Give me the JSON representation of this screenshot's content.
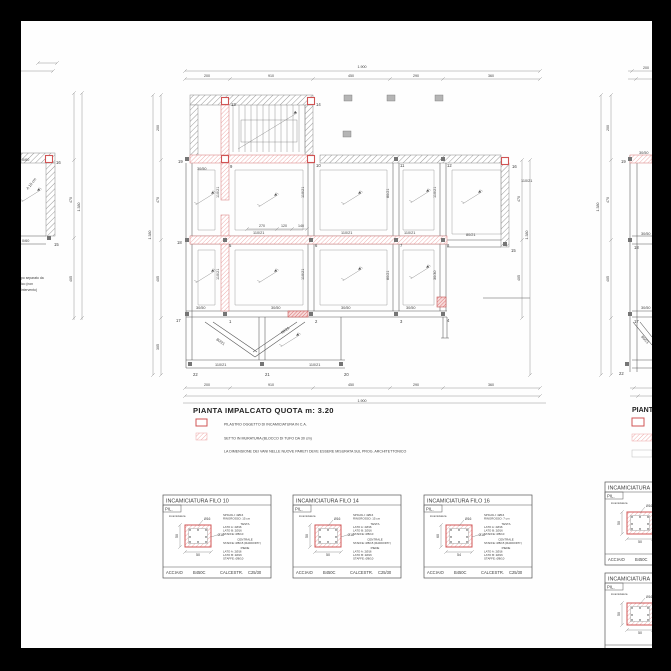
{
  "page": {
    "bg": "#000000",
    "sheet_bg": "#ffffff",
    "line_color": "#555555",
    "red_accent": "#d05454",
    "red_hatch": "#eda7a7",
    "gray_hatch": "#9a9a9a"
  },
  "title_block": {
    "title": "PIANTA IMPALCATO QUOTA m: 3.20",
    "legend": [
      {
        "swatch": "red-outline",
        "label": "PILASTRO OGGETTO DI INCAMICIATURA IN C.A."
      },
      {
        "swatch": "red-hatch",
        "label": "SETTO IN MURATURA (BLOCCO DI TUFO DA 30 cm)"
      },
      {
        "swatch": "none",
        "label": "LA DIMENSIONE DEI VANI NELLE NUOVE PARETI DEVE ESSERE MISURATA SUL PROG. ARCHITETTONICO"
      }
    ]
  },
  "main_plan": {
    "nodes": [
      {
        "id": "19",
        "x": 187,
        "y": 159,
        "lx": 178,
        "ly": 163
      },
      {
        "id": "13",
        "x": 225,
        "y": 101,
        "red": true,
        "lx": 231,
        "ly": 106
      },
      {
        "id": "14",
        "x": 311,
        "y": 101,
        "red": true,
        "lx": 316,
        "ly": 106
      },
      {
        "id": "9",
        "x": 225,
        "y": 159,
        "red": true,
        "lx": 230,
        "ly": 168
      },
      {
        "id": "10",
        "x": 311,
        "y": 159,
        "red": true,
        "lx": 316,
        "ly": 167
      },
      {
        "id": "11",
        "x": 396,
        "y": 159,
        "lx": 400,
        "ly": 167
      },
      {
        "id": "12",
        "x": 443,
        "y": 159,
        "lx": 447,
        "ly": 167
      },
      {
        "id": "16",
        "x": 505,
        "y": 161,
        "red": true,
        "lx": 512,
        "ly": 168
      },
      {
        "id": "18",
        "x": 187,
        "y": 240,
        "lx": 177,
        "ly": 244
      },
      {
        "id": "5",
        "x": 225,
        "y": 240,
        "lx": 229,
        "ly": 247
      },
      {
        "id": "6",
        "x": 311,
        "y": 240,
        "lx": 315,
        "ly": 247
      },
      {
        "id": "7",
        "x": 396,
        "y": 240,
        "lx": 400,
        "ly": 247
      },
      {
        "id": "8",
        "x": 443,
        "y": 240,
        "lx": 447,
        "ly": 247
      },
      {
        "id": "15",
        "x": 505,
        "y": 244,
        "lx": 511,
        "ly": 252
      },
      {
        "id": "17",
        "x": 187,
        "y": 314,
        "lx": 176,
        "ly": 322
      },
      {
        "id": "1",
        "x": 225,
        "y": 314,
        "lx": 229,
        "ly": 323
      },
      {
        "id": "2",
        "x": 311,
        "y": 314,
        "lx": 315,
        "ly": 323
      },
      {
        "id": "3",
        "x": 396,
        "y": 314,
        "lx": 400,
        "ly": 323
      },
      {
        "id": "4",
        "x": 443,
        "y": 314,
        "lx": 447,
        "ly": 322
      },
      {
        "id": "22",
        "x": 190,
        "y": 364,
        "lx": 193,
        "ly": 376
      },
      {
        "id": "21",
        "x": 262,
        "y": 364,
        "lx": 265,
        "ly": 376
      },
      {
        "id": "20",
        "x": 341,
        "y": 364,
        "lx": 344,
        "ly": 376
      }
    ],
    "labels": [
      {
        "t": "30/50",
        "x": 197,
        "y": 170
      },
      {
        "t": "110/21",
        "x": 521,
        "y": 182
      },
      {
        "t": "110/21",
        "x": 219,
        "y": 198,
        "r": -90,
        "c": "red"
      },
      {
        "t": "110/21",
        "x": 304,
        "y": 198,
        "r": -90
      },
      {
        "t": "80/21",
        "x": 389,
        "y": 198,
        "r": -90
      },
      {
        "t": "110/21",
        "x": 436,
        "y": 198,
        "r": -90
      },
      {
        "t": "110/21",
        "x": 253,
        "y": 234
      },
      {
        "t": "110/21",
        "x": 341,
        "y": 234
      },
      {
        "t": "110/21",
        "x": 404,
        "y": 234
      },
      {
        "t": "80/21",
        "x": 466,
        "y": 236
      },
      {
        "t": "110/21",
        "x": 219,
        "y": 280,
        "r": -90,
        "c": "red"
      },
      {
        "t": "110/21",
        "x": 304,
        "y": 280,
        "r": -90
      },
      {
        "t": "80/21",
        "x": 389,
        "y": 280,
        "r": -90
      },
      {
        "t": "30/30",
        "x": 436,
        "y": 280,
        "r": -90
      },
      {
        "t": "30/50",
        "x": 196,
        "y": 309
      },
      {
        "t": "30/50",
        "x": 271,
        "y": 309
      },
      {
        "t": "30/50",
        "x": 341,
        "y": 309
      },
      {
        "t": "30/50",
        "x": 406,
        "y": 309
      },
      {
        "t": "110/21",
        "x": 215,
        "y": 366
      },
      {
        "t": "110/21",
        "x": 309,
        "y": 366
      },
      {
        "t": "80/21",
        "x": 216,
        "y": 340,
        "r": 35
      },
      {
        "t": "80/21",
        "x": 282,
        "y": 334,
        "r": -35
      }
    ],
    "slope_arrows": [
      [
        205,
        199
      ],
      [
        268,
        201
      ],
      [
        352,
        199
      ],
      [
        420,
        197
      ],
      [
        472,
        198
      ],
      [
        205,
        277
      ],
      [
        268,
        277
      ],
      [
        352,
        275
      ],
      [
        420,
        273
      ],
      [
        290,
        341
      ]
    ],
    "dims": [
      {
        "o": "h",
        "y": 71,
        "x1": 185,
        "x2": 540,
        "ticks": [
          185,
          540
        ],
        "labels": [
          {
            "t": "1.900",
            "x": 362,
            "y": 68
          }
        ]
      },
      {
        "o": "h",
        "y": 79,
        "x1": 185,
        "x2": 540,
        "ticks": [
          185,
          230,
          313,
          390,
          443,
          540
        ],
        "labels": [
          {
            "t": "200",
            "x": 207,
            "y": 77
          },
          {
            "t": "910",
            "x": 271,
            "y": 77
          },
          {
            "t": "450",
            "x": 351,
            "y": 77
          },
          {
            "t": "290",
            "x": 416,
            "y": 77
          },
          {
            "t": "360",
            "x": 491,
            "y": 77
          }
        ]
      },
      {
        "o": "h",
        "y": 388,
        "x1": 185,
        "x2": 540,
        "ticks": [
          185,
          230,
          313,
          390,
          443,
          540
        ],
        "labels": [
          {
            "t": "200",
            "x": 207,
            "y": 386
          },
          {
            "t": "910",
            "x": 271,
            "y": 386
          },
          {
            "t": "450",
            "x": 351,
            "y": 386
          },
          {
            "t": "290",
            "x": 416,
            "y": 386
          },
          {
            "t": "360",
            "x": 491,
            "y": 386
          }
        ]
      },
      {
        "o": "h",
        "y": 396,
        "x1": 185,
        "x2": 540,
        "ticks": [
          185,
          540
        ],
        "labels": [
          {
            "t": "1.900",
            "x": 362,
            "y": 402
          }
        ]
      },
      {
        "o": "v",
        "x": 153,
        "y1": 95,
        "y2": 375,
        "ticks": [
          95,
          375
        ],
        "labels": [
          {
            "t": "1.380",
            "x": 151,
            "y": 235,
            "r": -90
          }
        ]
      },
      {
        "o": "v",
        "x": 161,
        "y1": 95,
        "y2": 375,
        "ticks": [
          95,
          160,
          240,
          318,
          375
        ],
        "labels": [
          {
            "t": "200",
            "x": 159,
            "y": 128,
            "r": -90
          },
          {
            "t": "470",
            "x": 159,
            "y": 200,
            "r": -90
          },
          {
            "t": "405",
            "x": 159,
            "y": 279,
            "r": -90
          },
          {
            "t": "305",
            "x": 159,
            "y": 347,
            "r": -90
          }
        ]
      },
      {
        "o": "v",
        "x": 522,
        "y1": 160,
        "y2": 318,
        "ticks": [
          160,
          240,
          318
        ],
        "labels": [
          {
            "t": "470",
            "x": 520,
            "y": 199,
            "r": -90
          },
          {
            "t": "405",
            "x": 520,
            "y": 278,
            "r": -90
          }
        ]
      },
      {
        "o": "v",
        "x": 530,
        "y1": 160,
        "y2": 375,
        "ticks": [
          160,
          375
        ],
        "labels": [
          {
            "t": "1.380",
            "x": 528,
            "y": 235,
            "r": -90
          }
        ]
      },
      {
        "o": "h",
        "y": 229,
        "x1": 247,
        "x2": 307,
        "ticks": [
          247,
          277,
          292,
          307
        ],
        "labels": [
          {
            "t": "270",
            "x": 262,
            "y": 227
          },
          {
            "t": "120",
            "x": 284,
            "y": 227
          },
          {
            "t": "140",
            "x": 301,
            "y": 227
          }
        ]
      }
    ]
  },
  "left_fragment": {
    "labels": [
      {
        "t": "0/60",
        "x": 22,
        "y": 161
      },
      {
        "t": "0/60",
        "x": 22,
        "y": 242
      },
      {
        "t": "A 15 cm",
        "x": 28,
        "y": 190,
        "r": -52
      }
    ],
    "nodes": [
      {
        "id": "16",
        "x": 49,
        "y": 159,
        "red": true,
        "lx": 56,
        "ly": 164
      },
      {
        "id": "15",
        "x": 49,
        "y": 238,
        "lx": 54,
        "ly": 246
      }
    ],
    "note_lines": [
      "po separato da",
      "ico (non",
      "intervento)"
    ],
    "slope_arrows": [
      [
        31,
        196
      ]
    ],
    "dims": [
      {
        "o": "v",
        "x": 74,
        "y1": 93,
        "y2": 320,
        "ticks": [
          93,
          160,
          238,
          318
        ],
        "labels": [
          {
            "t": "470",
            "x": 72,
            "y": 200,
            "r": -90
          },
          {
            "t": "405",
            "x": 72,
            "y": 279,
            "r": -90
          }
        ]
      },
      {
        "o": "v",
        "x": 82,
        "y1": 93,
        "y2": 320,
        "ticks": [
          93,
          318
        ],
        "labels": [
          {
            "t": "1.380",
            "x": 80,
            "y": 207,
            "r": -90
          }
        ]
      },
      {
        "o": "h",
        "y": 63,
        "x1": 38,
        "x2": 57,
        "ticks": [
          38,
          57
        ],
        "labels": []
      },
      {
        "o": "h",
        "y": 71,
        "x1": 21,
        "x2": 53,
        "ticks": [
          53
        ],
        "labels": []
      }
    ]
  },
  "right_fragment": {
    "title_fragment": "PIANTA",
    "nodes": [
      {
        "id": "19",
        "x": 630,
        "y": 159,
        "lx": 621,
        "ly": 163
      },
      {
        "id": "18",
        "x": 630,
        "y": 240,
        "lx": 634,
        "ly": 249
      },
      {
        "id": "17",
        "x": 630,
        "y": 314,
        "lx": 634,
        "ly": 323
      },
      {
        "id": "22",
        "x": 627,
        "y": 364,
        "lx": 619,
        "ly": 375
      }
    ],
    "labels": [
      {
        "t": "30/50",
        "x": 639,
        "y": 154
      },
      {
        "t": "30/50",
        "x": 641,
        "y": 235
      },
      {
        "t": "30/50",
        "x": 641,
        "y": 309
      },
      {
        "t": "80/21",
        "x": 641,
        "y": 337,
        "r": 48
      }
    ],
    "dims": [
      {
        "o": "v",
        "x": 601,
        "y1": 95,
        "y2": 375,
        "ticks": [
          95,
          375
        ],
        "labels": [
          {
            "t": "1.380",
            "x": 599,
            "y": 207,
            "r": -90
          }
        ]
      },
      {
        "o": "v",
        "x": 611,
        "y1": 95,
        "y2": 375,
        "ticks": [
          95,
          160,
          240,
          318,
          375
        ],
        "labels": [
          {
            "t": "200",
            "x": 609,
            "y": 128,
            "r": -90
          },
          {
            "t": "470",
            "x": 609,
            "y": 200,
            "r": -90
          },
          {
            "t": "405",
            "x": 609,
            "y": 279,
            "r": -90
          }
        ]
      },
      {
        "o": "h",
        "y": 71,
        "x1": 628,
        "x2": 652,
        "ticks": [
          632
        ],
        "labels": [
          {
            "t": "200",
            "x": 646,
            "y": 69
          }
        ]
      },
      {
        "o": "h",
        "y": 79,
        "x1": 628,
        "x2": 652,
        "ticks": [
          636
        ],
        "labels": []
      },
      {
        "o": "h",
        "y": 388,
        "x1": 630,
        "x2": 652,
        "ticks": [
          634
        ],
        "labels": []
      },
      {
        "o": "h",
        "y": 396,
        "x1": 630,
        "x2": 652,
        "ticks": [
          638
        ],
        "labels": []
      }
    ]
  },
  "detail_boxes": {
    "pil_label": "PIL.",
    "section_note": "incamiciatura",
    "callout1": "Ø16",
    "callout2": "Ø16",
    "footer_tokens": [
      "ACCIAIO",
      "B450C",
      "CALCESTR.",
      "C25/30"
    ],
    "boxes": [
      {
        "title": "INCAMICIATURA FILO 10",
        "dim_w": "50",
        "dim_h": "50",
        "specs": [
          [
            "SPIGOLI: 4Ø16",
            "RINGROSSO: 15 cm"
          ],
          [
            "TESTA",
            "LATO A: 2Ø16",
            "LATO B: 2Ø16",
            "STAFFE: Ø8/10"
          ],
          [
            "CENTRALE",
            "STAFFE: Ø8/15 (RADDOPP.)"
          ],
          [
            "PIEDE",
            "LATO A: 2Ø16",
            "LATO B: 2Ø16",
            "STAFFE: Ø8/10"
          ]
        ]
      },
      {
        "title": "INCAMICIATURA FILO 14",
        "dim_w": "50",
        "dim_h": "50",
        "specs": [
          [
            "SPIGOLI: 4Ø16",
            "RINGROSSO: 15 cm"
          ],
          [
            "TESTA",
            "LATO A: 2Ø16",
            "LATO B: 2Ø16",
            "STAFFE: Ø8/10"
          ],
          [
            "CENTRALE",
            "STAFFE: Ø8/15 (RADDOPP.)"
          ],
          [
            "PIEDE",
            "LATO A: 2Ø16",
            "LATO B: 2Ø16",
            "STAFFE: Ø8/10"
          ]
        ]
      },
      {
        "title": "INCAMICIATURA FILO 16",
        "dim_w": "54",
        "dim_h": "60",
        "specs": [
          [
            "SPIGOLI: 4Ø16",
            "RINGROSSO: 7 cm"
          ],
          [
            "TESTA",
            "LATO A: 2Ø16",
            "LATO B: 2Ø16",
            "STAFFE: Ø8/10"
          ],
          [
            "CENTRALE",
            "STAFFE: Ø8/15 (RADDOPP.)"
          ],
          [
            "PIEDE",
            "LATO A: 2Ø16",
            "LATO B: 2Ø16",
            "STAFFE: Ø8/10"
          ]
        ]
      }
    ],
    "partial_boxes": [
      {
        "title": "INCAMICIATURA",
        "dim_w": "50",
        "dim_h": "50"
      },
      {
        "title": "INCAMICIATURA",
        "dim_w": "50",
        "dim_h": "50"
      }
    ]
  }
}
